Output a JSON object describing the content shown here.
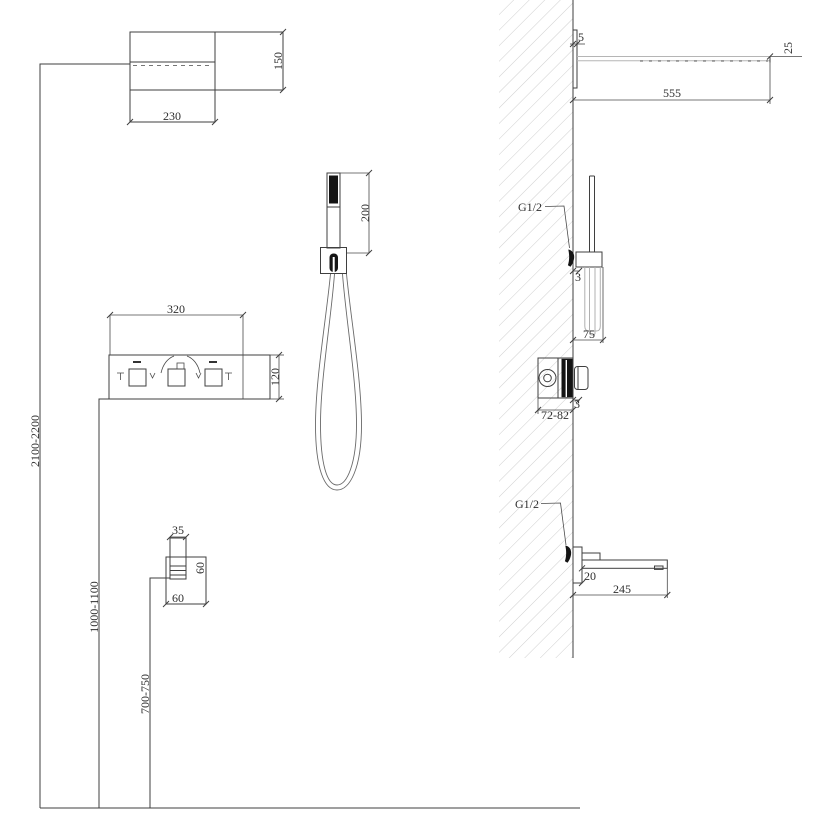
{
  "colors": {
    "line": "#3f3f3f",
    "light_line": "#b5b5b5",
    "hatch": "#cfcfcf",
    "solid_fill": "#141414"
  },
  "front_view": {
    "head": {
      "width": "230",
      "depth": "150"
    },
    "hand_shower": {
      "length": "200"
    },
    "panel": {
      "width": "320",
      "height": "120"
    },
    "outlet": {
      "spout_width": "35",
      "height": "60",
      "width": "60"
    },
    "heights": {
      "head": "2100-2200",
      "panel": "1000-1100",
      "outlet": "700-750"
    }
  },
  "side_view": {
    "head": {
      "wall_gap": "5",
      "end_thickness": "25",
      "length": "555"
    },
    "holder": {
      "connection": "G1/2",
      "wall_gap": "3",
      "depth": "75"
    },
    "valve": {
      "trim_gap": "3",
      "body_depth": "72-82"
    },
    "spout": {
      "connection": "G1/2",
      "drop": "20",
      "length": "245"
    }
  }
}
